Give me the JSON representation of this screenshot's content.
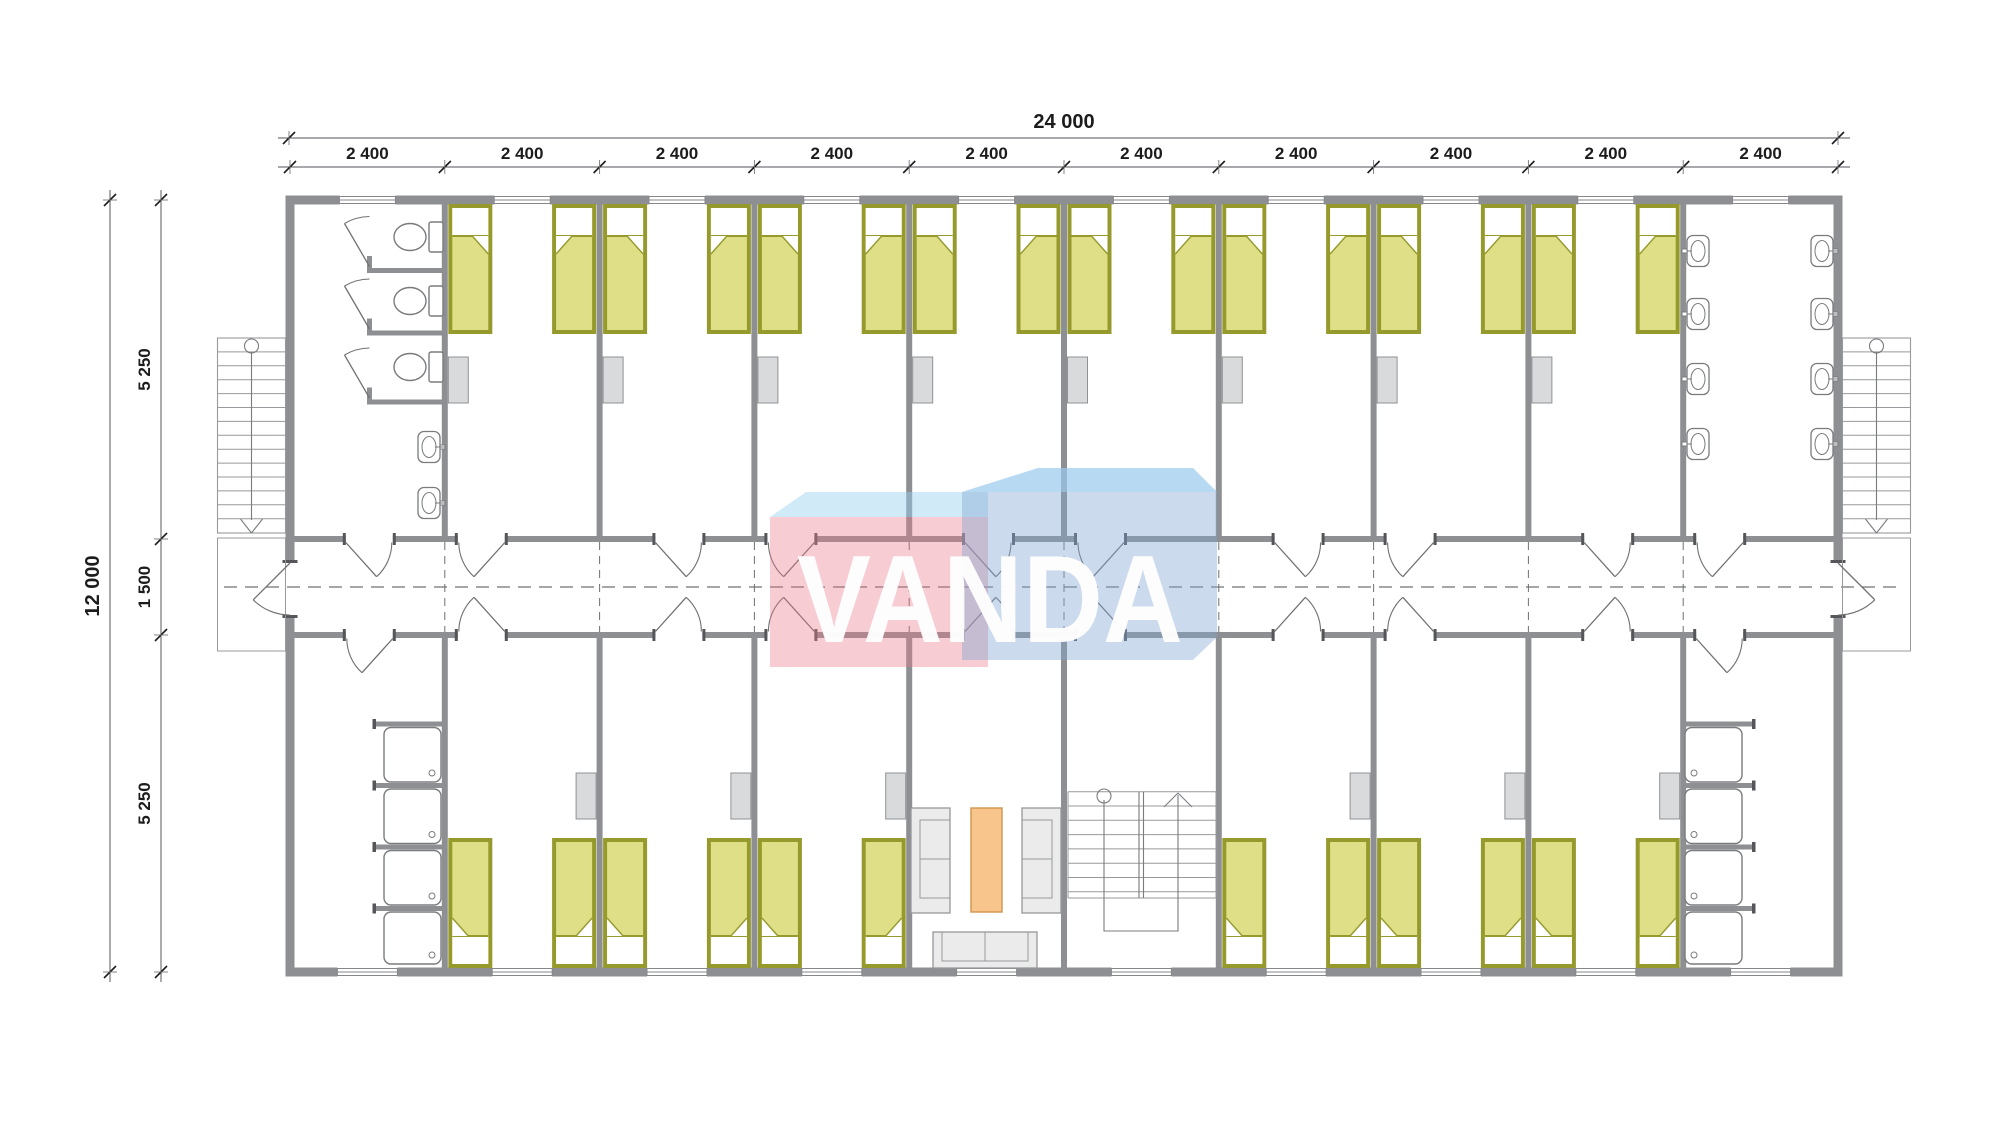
{
  "dimensions": {
    "top_total_label": "24 000",
    "top_segment_labels": [
      "2 400",
      "2 400",
      "2 400",
      "2 400",
      "2 400",
      "2 400",
      "2 400",
      "2 400",
      "2 400",
      "2 400"
    ],
    "left_total_label": "12 000",
    "left_segment_labels": [
      "5 250",
      "1 500",
      "5 250"
    ]
  },
  "watermark": {
    "text": "VANDA",
    "text_color": "#ffffff",
    "pink_face": "rgba(233,122,140,0.38)",
    "pink_top": "rgba(150,208,240,0.45)",
    "blue_face": "rgba(130,168,210,0.42)",
    "blue_top": "rgba(165,215,248,0.5)"
  },
  "plan": {
    "modules": 10,
    "module_width_mm": 2400,
    "total_width_mm": 24000,
    "total_depth_mm": 12000,
    "depth_segments_mm": [
      5250,
      1500,
      5250
    ],
    "rooms_top": [
      "toilet-room",
      "bedroom",
      "bedroom",
      "bedroom",
      "bedroom",
      "bedroom",
      "bedroom",
      "bedroom",
      "bedroom",
      "washroom"
    ],
    "rooms_bottom": [
      "shower-room",
      "bedroom",
      "bedroom",
      "bedroom",
      "lounge",
      "stair-room",
      "bedroom",
      "bedroom",
      "bedroom",
      "shower-room"
    ],
    "fixtures": {
      "beds_top_row": 16,
      "beds_bottom_row": 12,
      "toilets": 3,
      "hand_basins": 2,
      "wash_basins": 8,
      "shower_trays": 8,
      "wardrobes": 14,
      "external_stairs": 2,
      "internal_stairs": 1,
      "sofas": 3,
      "coffee_tables": 1
    },
    "colors": {
      "floor": "#ffffff",
      "wall": "#8d8f92",
      "wall_cap": "#54565a",
      "line": "#8f9193",
      "stair_line": "#97999c",
      "fixture": "#797b7e",
      "door": "#6f7173",
      "bed_border": "#969a2c",
      "bed_fill": "#dedf86",
      "pillow": "#ffffff",
      "cabinet_fill": "#d9dadb",
      "cabinet_stroke": "#8f9193",
      "sofa_fill": "#ebebeb",
      "sofa_stroke": "#96989b",
      "table_fill": "#f8c58d",
      "table_stroke": "#d1944d",
      "dim_text": "#1c1c1c",
      "dim_line": "#74767a",
      "axis_dash": "#6e7073"
    }
  }
}
